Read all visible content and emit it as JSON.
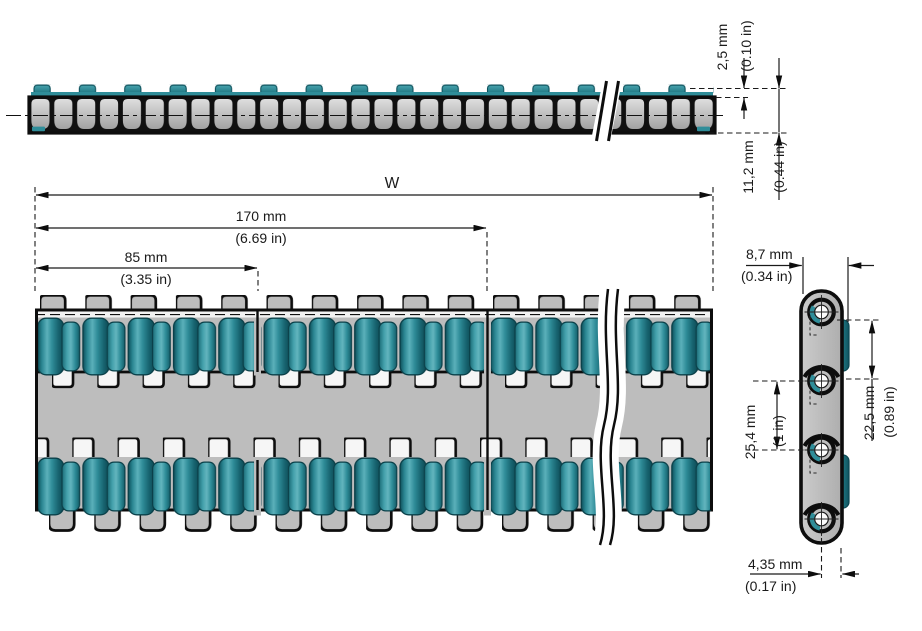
{
  "views": {
    "elevation": {
      "insert_protrusion": {
        "metric": "2,5 mm",
        "imperial": "(0.10 in)"
      },
      "belt_thickness": {
        "metric": "11,2 mm",
        "imperial": "(0.44 in)"
      }
    },
    "plan": {
      "belt_width_label": "W",
      "dim_170": {
        "metric": "170 mm",
        "imperial": "(6.69 in)"
      },
      "dim_85": {
        "metric": "85 mm",
        "imperial": "(3.35 in)"
      }
    },
    "side": {
      "link_width": {
        "metric": "8,7 mm",
        "imperial": "(0.34 in)"
      },
      "insert_length": {
        "metric": "22,5 mm",
        "imperial": "(0.89 in)"
      },
      "pitch": {
        "metric": "25,4 mm",
        "imperial": "(1 in)"
      },
      "pin_edge_offset": {
        "metric": "4,35 mm",
        "imperial": "(0.17 in)"
      }
    }
  },
  "colors": {
    "insert_teal": "#2F8D99",
    "link_gray": "#BDBDBD",
    "outline": "#0D0D0D",
    "background": "#FFFFFF"
  }
}
